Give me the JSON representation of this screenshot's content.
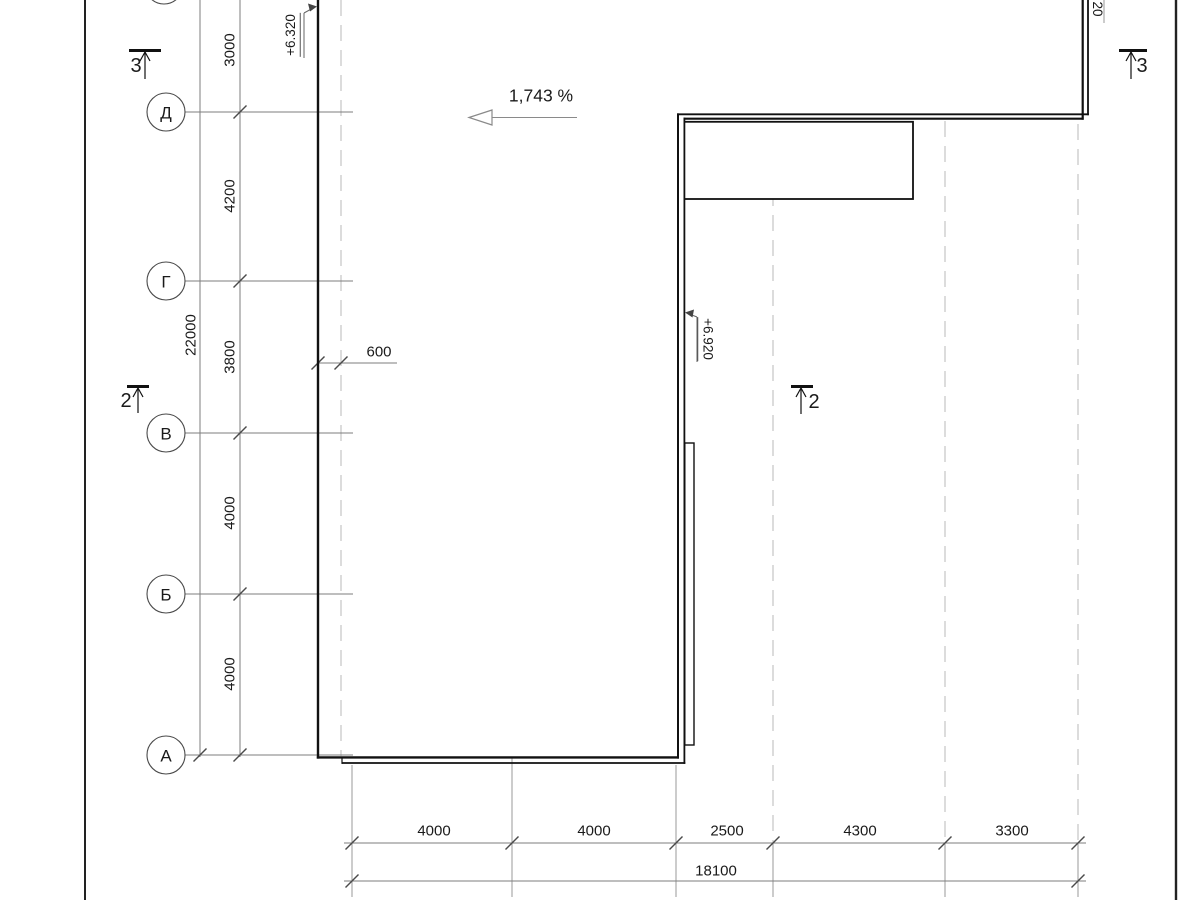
{
  "axis_rows": [
    {
      "label": "Д"
    },
    {
      "label": "Г"
    },
    {
      "label": "В"
    },
    {
      "label": "Б"
    },
    {
      "label": "А"
    }
  ],
  "row_dims": [
    "3000",
    "4200",
    "3800",
    "4000",
    "4000"
  ],
  "row_total": "22000",
  "col_dims": [
    "4000",
    "4000",
    "2500",
    "4300",
    "3300"
  ],
  "col_total": "18100",
  "offset_dim": "600",
  "slope_label": "1,743 %",
  "elevations": {
    "top_left": "+6.320",
    "mid_wall": "+6.920",
    "top_right_partial": "20"
  },
  "sections": {
    "three_left": "3",
    "three_right": "3",
    "two_left": "2",
    "two_right": "2"
  }
}
